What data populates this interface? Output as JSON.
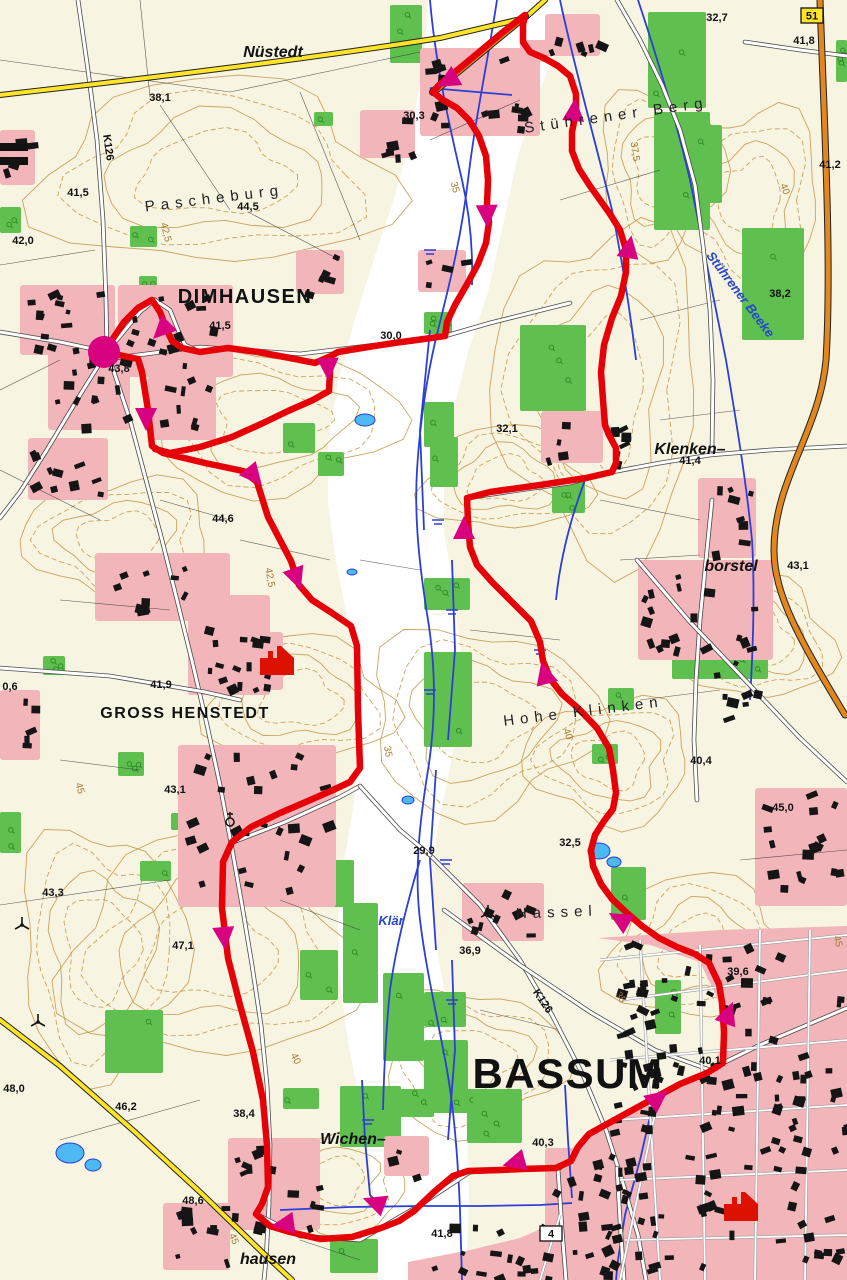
{
  "map": {
    "colors": {
      "background": "#f8f4e2",
      "valley": "#ffffff",
      "forest": "#5fc04f",
      "settlement": "#f2b6ba",
      "contour": "#c49a4e",
      "water": "#2b3fd8",
      "lake": "#4db8f2",
      "road_yellow": "#ffe429",
      "road_orange": "#e2861e",
      "route_red": "#e60008",
      "marker_magenta": "#d8017f"
    },
    "labels": [
      {
        "t": "38,1",
        "x": 160,
        "y": 101,
        "cls": "elev"
      },
      {
        "t": "41,5",
        "x": 78,
        "y": 196,
        "cls": "elev"
      },
      {
        "t": "42,0",
        "x": 23,
        "y": 244,
        "cls": "elev"
      },
      {
        "t": "44,5",
        "x": 248,
        "y": 210,
        "cls": "elev"
      },
      {
        "t": "30,3",
        "x": 414,
        "y": 119,
        "cls": "elev"
      },
      {
        "t": "30,0",
        "x": 391,
        "y": 339,
        "cls": "elev"
      },
      {
        "t": "41,5",
        "x": 220,
        "y": 329,
        "cls": "elev"
      },
      {
        "t": "43,8",
        "x": 119,
        "y": 372,
        "cls": "elev"
      },
      {
        "t": "44,6",
        "x": 223,
        "y": 522,
        "cls": "elev"
      },
      {
        "t": "32,7",
        "x": 717,
        "y": 21,
        "cls": "elev"
      },
      {
        "t": "41,8",
        "x": 804,
        "y": 44,
        "cls": "elev"
      },
      {
        "t": "41,2",
        "x": 830,
        "y": 168,
        "cls": "elev"
      },
      {
        "t": "38,2",
        "x": 780,
        "y": 297,
        "cls": "elev"
      },
      {
        "t": "32,1",
        "x": 507,
        "y": 432,
        "cls": "elev"
      },
      {
        "t": "41,4",
        "x": 690,
        "y": 464,
        "cls": "elev"
      },
      {
        "t": "43,1",
        "x": 798,
        "y": 569,
        "cls": "elev"
      },
      {
        "t": "41,9",
        "x": 161,
        "y": 688,
        "cls": "elev"
      },
      {
        "t": "43,1",
        "x": 175,
        "y": 793,
        "cls": "elev"
      },
      {
        "t": "0,6",
        "x": 10,
        "y": 690,
        "cls": "elev"
      },
      {
        "t": "40,4",
        "x": 701,
        "y": 764,
        "cls": "elev"
      },
      {
        "t": "45,0",
        "x": 783,
        "y": 811,
        "cls": "elev"
      },
      {
        "t": "32,5",
        "x": 570,
        "y": 846,
        "cls": "elev"
      },
      {
        "t": "29,9",
        "x": 424,
        "y": 854,
        "cls": "elev"
      },
      {
        "t": "43,3",
        "x": 53,
        "y": 896,
        "cls": "elev"
      },
      {
        "t": "47,1",
        "x": 183,
        "y": 949,
        "cls": "elev"
      },
      {
        "t": "48,0",
        "x": 14,
        "y": 1092,
        "cls": "elev"
      },
      {
        "t": "46,2",
        "x": 126,
        "y": 1110,
        "cls": "elev"
      },
      {
        "t": "38,4",
        "x": 244,
        "y": 1117,
        "cls": "elev"
      },
      {
        "t": "48,6",
        "x": 193,
        "y": 1204,
        "cls": "elev"
      },
      {
        "t": "36,9",
        "x": 470,
        "y": 954,
        "cls": "elev"
      },
      {
        "t": "39,6",
        "x": 738,
        "y": 975,
        "cls": "elev"
      },
      {
        "t": "40,1",
        "x": 710,
        "y": 1064,
        "cls": "elev"
      },
      {
        "t": "40,3",
        "x": 543,
        "y": 1146,
        "cls": "elev"
      },
      {
        "t": "41,8",
        "x": 442,
        "y": 1237,
        "cls": "elev"
      },
      {
        "t": "DIMHAUSEN",
        "x": 245,
        "y": 303,
        "cls": "town",
        "fs": 20
      },
      {
        "t": "GROSS HENSTEDT",
        "x": 185,
        "y": 718,
        "cls": "town",
        "fs": 16
      },
      {
        "t": "BASSUM",
        "x": 568,
        "y": 1088,
        "cls": "town",
        "fs": 42
      },
      {
        "t": "Nüstedt",
        "x": 273,
        "y": 57,
        "cls": "village"
      },
      {
        "t": "Klenken–",
        "x": 690,
        "y": 454,
        "cls": "village"
      },
      {
        "t": "borstel",
        "x": 731,
        "y": 571,
        "cls": "village"
      },
      {
        "t": "Wichen–",
        "x": 353,
        "y": 1144,
        "cls": "village"
      },
      {
        "t": "hausen",
        "x": 268,
        "y": 1264,
        "cls": "village"
      },
      {
        "t": "Pascheburg",
        "x": 215,
        "y": 203,
        "cls": "field",
        "rot": -7
      },
      {
        "t": "Stührener Berg",
        "x": 617,
        "y": 120,
        "cls": "field",
        "rot": -8
      },
      {
        "t": "Hohe Klinken",
        "x": 584,
        "y": 716,
        "cls": "field",
        "rot": -7
      },
      {
        "t": "Hassel",
        "x": 557,
        "y": 917,
        "cls": "field",
        "rot": -2
      },
      {
        "t": "Stührener Beeke",
        "x": 737,
        "y": 297,
        "cls": "water",
        "rot": 53
      },
      {
        "t": "Klär",
        "x": 391,
        "y": 925,
        "cls": "water"
      },
      {
        "t": "42,5",
        "x": 163,
        "y": 233,
        "cls": "contour",
        "rot": 76
      },
      {
        "t": "37,5",
        "x": 632,
        "y": 152,
        "cls": "contour",
        "rot": 82
      },
      {
        "t": "35",
        "x": 452,
        "y": 188,
        "cls": "contour",
        "rot": 75
      },
      {
        "t": "40",
        "x": 782,
        "y": 190,
        "cls": "contour",
        "rot": 70
      },
      {
        "t": "42,5",
        "x": 267,
        "y": 578,
        "cls": "contour",
        "rot": 80
      },
      {
        "t": "45",
        "x": 77,
        "y": 789,
        "cls": "contour",
        "rot": 75
      },
      {
        "t": "35",
        "x": 385,
        "y": 752,
        "cls": "contour",
        "rot": 80
      },
      {
        "t": "40",
        "x": 565,
        "y": 735,
        "cls": "contour",
        "rot": 72
      },
      {
        "t": "40",
        "x": 293,
        "y": 1060,
        "cls": "contour",
        "rot": 64
      },
      {
        "t": "35",
        "x": 618,
        "y": 999,
        "cls": "contour",
        "rot": 58
      },
      {
        "t": "45",
        "x": 835,
        "y": 942,
        "cls": "contour",
        "rot": 76
      },
      {
        "t": "45",
        "x": 231,
        "y": 1240,
        "cls": "contour",
        "rot": 68
      },
      {
        "t": "K126",
        "x": 105,
        "y": 148,
        "cls": "roadlabel",
        "rot": 82
      },
      {
        "t": "K126",
        "x": 540,
        "y": 1003,
        "cls": "roadlabel",
        "rot": 56
      }
    ],
    "road_badges": [
      {
        "text": "51",
        "x": 812,
        "y": 8,
        "style": "yellow"
      },
      {
        "text": "4",
        "x": 551,
        "y": 1226,
        "style": "white"
      }
    ],
    "route": {
      "start_marker": {
        "x": 104,
        "y": 352,
        "r": 16
      },
      "house_markers": [
        {
          "x": 277,
          "y": 660
        },
        {
          "x": 741,
          "y": 1206
        }
      ],
      "points": [
        [
          104,
          352
        ],
        [
          138,
          359
        ],
        [
          142,
          372
        ],
        [
          148,
          410
        ],
        [
          152,
          446
        ],
        [
          163,
          453
        ],
        [
          205,
          463
        ],
        [
          243,
          471
        ],
        [
          257,
          482
        ],
        [
          268,
          517
        ],
        [
          291,
          561
        ],
        [
          299,
          585
        ],
        [
          312,
          600
        ],
        [
          332,
          613
        ],
        [
          351,
          626
        ],
        [
          357,
          646
        ],
        [
          358,
          710
        ],
        [
          360,
          768
        ],
        [
          350,
          782
        ],
        [
          333,
          790
        ],
        [
          308,
          801
        ],
        [
          280,
          813
        ],
        [
          251,
          827
        ],
        [
          232,
          842
        ],
        [
          223,
          862
        ],
        [
          222,
          908
        ],
        [
          228,
          958
        ],
        [
          240,
          1005
        ],
        [
          253,
          1052
        ],
        [
          263,
          1100
        ],
        [
          267,
          1145
        ],
        [
          268,
          1187
        ],
        [
          262,
          1204
        ],
        [
          256,
          1214
        ],
        [
          270,
          1226
        ],
        [
          290,
          1232
        ],
        [
          320,
          1239
        ],
        [
          352,
          1237
        ],
        [
          381,
          1228
        ],
        [
          399,
          1221
        ],
        [
          414,
          1211
        ],
        [
          434,
          1192
        ],
        [
          453,
          1176
        ],
        [
          468,
          1171
        ],
        [
          500,
          1170
        ],
        [
          522,
          1169
        ],
        [
          556,
          1168
        ],
        [
          571,
          1161
        ],
        [
          578,
          1147
        ],
        [
          589,
          1134
        ],
        [
          618,
          1118
        ],
        [
          649,
          1101
        ],
        [
          680,
          1084
        ],
        [
          707,
          1073
        ],
        [
          723,
          1063
        ],
        [
          724,
          1032
        ],
        [
          722,
          1002
        ],
        [
          719,
          984
        ],
        [
          709,
          963
        ],
        [
          695,
          954
        ],
        [
          677,
          947
        ],
        [
          659,
          938
        ],
        [
          642,
          926
        ],
        [
          627,
          913
        ],
        [
          612,
          899
        ],
        [
          601,
          884
        ],
        [
          593,
          866
        ],
        [
          591,
          850
        ],
        [
          595,
          835
        ],
        [
          604,
          821
        ],
        [
          613,
          809
        ],
        [
          616,
          793
        ],
        [
          613,
          770
        ],
        [
          609,
          748
        ],
        [
          597,
          728
        ],
        [
          579,
          709
        ],
        [
          562,
          694
        ],
        [
          551,
          680
        ],
        [
          543,
          661
        ],
        [
          540,
          642
        ],
        [
          531,
          621
        ],
        [
          511,
          601
        ],
        [
          492,
          582
        ],
        [
          477,
          565
        ],
        [
          470,
          547
        ],
        [
          468,
          522
        ],
        [
          467,
          498
        ],
        [
          490,
          492
        ],
        [
          540,
          485
        ],
        [
          586,
          478
        ],
        [
          612,
          472
        ],
        [
          616,
          463
        ],
        [
          616,
          448
        ],
        [
          609,
          435
        ],
        [
          605,
          425
        ],
        [
          603,
          400
        ],
        [
          601,
          372
        ],
        [
          604,
          345
        ],
        [
          612,
          318
        ],
        [
          621,
          296
        ],
        [
          626,
          272
        ],
        [
          626,
          250
        ],
        [
          620,
          230
        ],
        [
          610,
          214
        ],
        [
          600,
          200
        ],
        [
          590,
          186
        ],
        [
          579,
          169
        ],
        [
          572,
          151
        ],
        [
          572,
          132
        ],
        [
          576,
          112
        ],
        [
          576,
          94
        ],
        [
          570,
          76
        ],
        [
          558,
          66
        ],
        [
          544,
          58
        ],
        [
          530,
          52
        ],
        [
          523,
          42
        ],
        [
          523,
          25
        ],
        [
          525,
          15
        ],
        [
          503,
          32
        ],
        [
          478,
          53
        ],
        [
          455,
          72
        ],
        [
          440,
          84
        ],
        [
          433,
          92
        ],
        [
          443,
          100
        ],
        [
          457,
          108
        ],
        [
          469,
          120
        ],
        [
          479,
          136
        ],
        [
          486,
          156
        ],
        [
          488,
          180
        ],
        [
          487,
          205
        ],
        [
          489,
          222
        ],
        [
          486,
          243
        ],
        [
          478,
          264
        ],
        [
          466,
          286
        ],
        [
          455,
          305
        ],
        [
          447,
          322
        ],
        [
          445,
          336
        ],
        [
          424,
          339
        ],
        [
          394,
          343
        ],
        [
          362,
          348
        ],
        [
          338,
          352
        ],
        [
          331,
          356
        ],
        [
          330,
          371
        ],
        [
          329,
          391
        ],
        [
          313,
          400
        ],
        [
          288,
          411
        ],
        [
          261,
          424
        ],
        [
          232,
          437
        ],
        [
          200,
          447
        ],
        [
          170,
          453
        ],
        [
          155,
          449
        ]
      ],
      "spur": [
        [
          104,
          352
        ],
        [
          112,
          340
        ],
        [
          124,
          322
        ],
        [
          138,
          308
        ],
        [
          152,
          300
        ],
        [
          160,
          312
        ],
        [
          166,
          328
        ],
        [
          172,
          341
        ],
        [
          182,
          348
        ],
        [
          200,
          352
        ],
        [
          228,
          348
        ],
        [
          258,
          352
        ],
        [
          290,
          358
        ],
        [
          315,
          363
        ],
        [
          331,
          356
        ]
      ],
      "arrows": [
        {
          "x": 163,
          "y": 329,
          "a": 225
        },
        {
          "x": 328,
          "y": 367,
          "a": 178
        },
        {
          "x": 146,
          "y": 417,
          "a": 180
        },
        {
          "x": 253,
          "y": 475,
          "a": 140
        },
        {
          "x": 296,
          "y": 577,
          "a": 160
        },
        {
          "x": 449,
          "y": 80,
          "a": 240
        },
        {
          "x": 487,
          "y": 214,
          "a": 178
        },
        {
          "x": 629,
          "y": 249,
          "a": 10
        },
        {
          "x": 574,
          "y": 112,
          "a": 5
        },
        {
          "x": 224,
          "y": 936,
          "a": 175
        },
        {
          "x": 285,
          "y": 1224,
          "a": 262
        },
        {
          "x": 376,
          "y": 1203,
          "a": 290
        },
        {
          "x": 516,
          "y": 1162,
          "a": 255
        },
        {
          "x": 657,
          "y": 1099,
          "a": 52
        },
        {
          "x": 728,
          "y": 1015,
          "a": 20
        },
        {
          "x": 621,
          "y": 920,
          "a": 300
        },
        {
          "x": 464,
          "y": 530,
          "a": 0
        },
        {
          "x": 545,
          "y": 675,
          "a": 345
        }
      ]
    }
  }
}
